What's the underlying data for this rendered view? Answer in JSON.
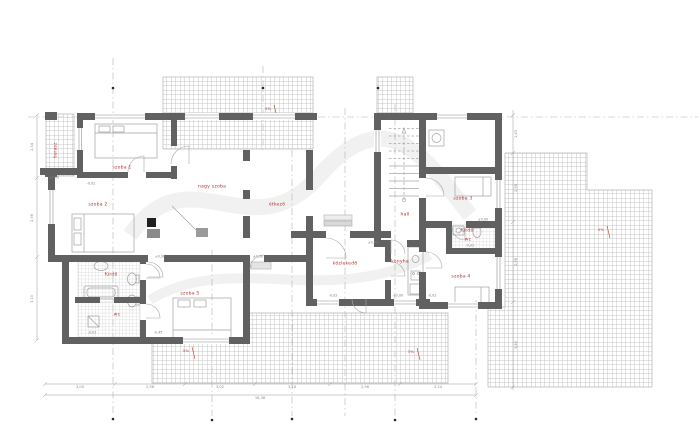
{
  "drawing": {
    "type": "floor-plan",
    "colors": {
      "wall": "#616161",
      "room_label": "#b23430",
      "dimension": "#8c8c8c",
      "hatch": "#c4c4c4",
      "furniture": "#a3a3a3",
      "slope_mark": "#c0392b"
    }
  },
  "room_labels": [
    {
      "name": "terasz",
      "x": 57,
      "y": 150,
      "rot": -90
    },
    {
      "name": "szoba 1",
      "x": 122,
      "y": 169
    },
    {
      "name": "szoba 2",
      "x": 98,
      "y": 206
    },
    {
      "name": "nagy szoba",
      "x": 212,
      "y": 188
    },
    {
      "name": "étkező",
      "x": 277,
      "y": 206
    },
    {
      "name": "közlekedő",
      "x": 345,
      "y": 265
    },
    {
      "name": "konyha",
      "x": 400,
      "y": 263
    },
    {
      "name": "hall",
      "x": 405,
      "y": 216
    },
    {
      "name": "szoba 3",
      "x": 463,
      "y": 200
    },
    {
      "name": "fürdő",
      "x": 467,
      "y": 232
    },
    {
      "name": "wc",
      "x": 468,
      "y": 241
    },
    {
      "name": "szoba 4",
      "x": 461,
      "y": 278
    },
    {
      "name": "fürdő",
      "x": 111,
      "y": 276
    },
    {
      "name": "wc",
      "x": 117,
      "y": 316
    },
    {
      "name": "szoba 5",
      "x": 190,
      "y": 295
    }
  ],
  "level_marks": [
    {
      "text": "±0,00",
      "x": 54,
      "y": 178
    },
    {
      "text": "-0,02",
      "x": 91,
      "y": 184
    },
    {
      "text": "±0,00",
      "x": 160,
      "y": 257
    },
    {
      "text": "±0,00",
      "x": 258,
      "y": 257
    },
    {
      "text": "-0,02",
      "x": 333,
      "y": 296
    },
    {
      "text": "±0,00",
      "x": 398,
      "y": 296
    },
    {
      "text": "-0,02",
      "x": 432,
      "y": 296
    },
    {
      "text": "-0,02",
      "x": 470,
      "y": 246
    },
    {
      "text": "±0,00",
      "x": 483,
      "y": 220
    },
    {
      "text": "-0,02",
      "x": 92,
      "y": 333
    },
    {
      "text": "-0,45",
      "x": 158,
      "y": 333
    },
    {
      "text": "±0,00",
      "x": 373,
      "y": 243
    }
  ],
  "slope_marks": [
    {
      "text": "5%",
      "x": 601,
      "y": 230
    },
    {
      "text": "5%",
      "x": 411,
      "y": 352
    },
    {
      "text": "5%",
      "x": 186,
      "y": 351
    },
    {
      "text": "5%",
      "x": 268,
      "y": 109
    }
  ],
  "dim_labels": [
    {
      "text": "3,00",
      "x": 80,
      "y": 388
    },
    {
      "text": "2,98",
      "x": 150,
      "y": 388
    },
    {
      "text": "3,02",
      "x": 220,
      "y": 388
    },
    {
      "text": "3,18",
      "x": 292,
      "y": 388
    },
    {
      "text": "2,96",
      "x": 365,
      "y": 388
    },
    {
      "text": "3,24",
      "x": 438,
      "y": 388
    },
    {
      "text": "18,38",
      "x": 260,
      "y": 399
    },
    {
      "text": "2,34",
      "x": 33,
      "y": 147,
      "rot": -90
    },
    {
      "text": "2,96",
      "x": 33,
      "y": 218,
      "rot": -90
    },
    {
      "text": "3,10",
      "x": 33,
      "y": 299,
      "rot": -90
    },
    {
      "text": "1,43",
      "x": 517,
      "y": 134,
      "rot": -90
    },
    {
      "text": "2,58",
      "x": 517,
      "y": 188,
      "rot": -90
    },
    {
      "text": "2,98",
      "x": 517,
      "y": 262,
      "rot": -90
    },
    {
      "text": "3,40",
      "x": 517,
      "y": 345,
      "rot": -90
    }
  ]
}
